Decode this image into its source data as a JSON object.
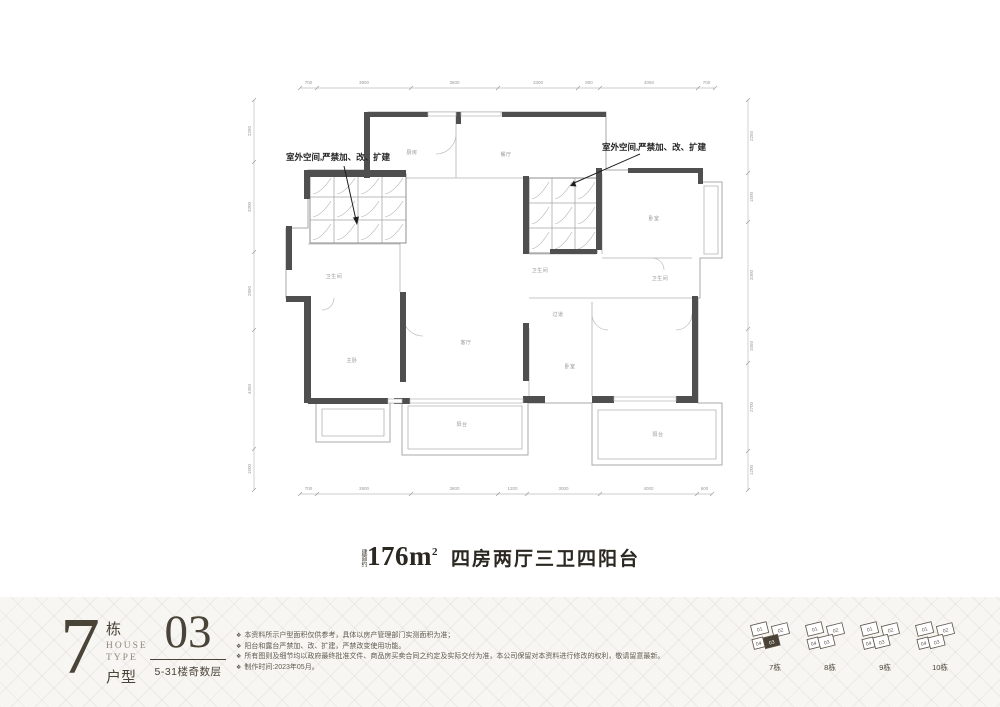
{
  "plan": {
    "annotation_left": "室外空间,严禁加、改、扩建",
    "annotation_right": "室外空间,严禁加、改、扩建",
    "rooms": [
      "厨房",
      "餐厅",
      "卧室",
      "卫生间",
      "主卧",
      "卫生间",
      "客厅",
      "过道",
      "卧室",
      "卫生间",
      "阳台",
      "阳台"
    ],
    "dims_top": [
      "700",
      "3900",
      "3600",
      "3300",
      "900",
      "4050",
      "700"
    ],
    "dims_bottom": [
      "700",
      "3900",
      "3600",
      "1200",
      "3000",
      "4000",
      "600"
    ],
    "dims_left": [
      "2250",
      "3300",
      "2850",
      "4350",
      "1500"
    ],
    "dims_right": [
      "2250",
      "1500",
      "3300",
      "1050",
      "2700",
      "1200"
    ]
  },
  "title": {
    "prefix": "建面约",
    "area": "176m",
    "sup": "2",
    "desc": "四房两厅三卫四阳台"
  },
  "footer": {
    "block_number": "7",
    "block_unit": "栋",
    "house": "HOUSE",
    "type": "TYPE",
    "huxing": "户型",
    "unit_number": "03",
    "floors": "5-31楼奇数层",
    "bullet": "❖",
    "disclaimers": [
      "本资料所示户型面积仅供参考，具体以房产管理部门实测面积为准；",
      "阳台和露台严禁加、改、扩建，严禁改变使用功能。",
      "所有图则及细节均以政府最终批准文件、商品房买卖合同之约定及实际交付为准，本公司保留对本资料进行修改的权利，敬请留意最新。",
      "制作时间:2023年05月。"
    ],
    "keyplans": [
      {
        "label": "7栋",
        "units": [
          "01",
          "02",
          "03",
          "04"
        ],
        "highlighted_unit": "03"
      },
      {
        "label": "8栋",
        "units": [
          "01",
          "02",
          "03",
          "04"
        ]
      },
      {
        "label": "9栋",
        "units": [
          "01",
          "02",
          "03",
          "04"
        ]
      },
      {
        "label": "10栋",
        "units": [
          "01",
          "02",
          "03",
          "04"
        ]
      }
    ]
  },
  "colors": {
    "wall": "#4f4f4f",
    "line": "#aaaaaa",
    "footer_text": "#4a4338"
  }
}
